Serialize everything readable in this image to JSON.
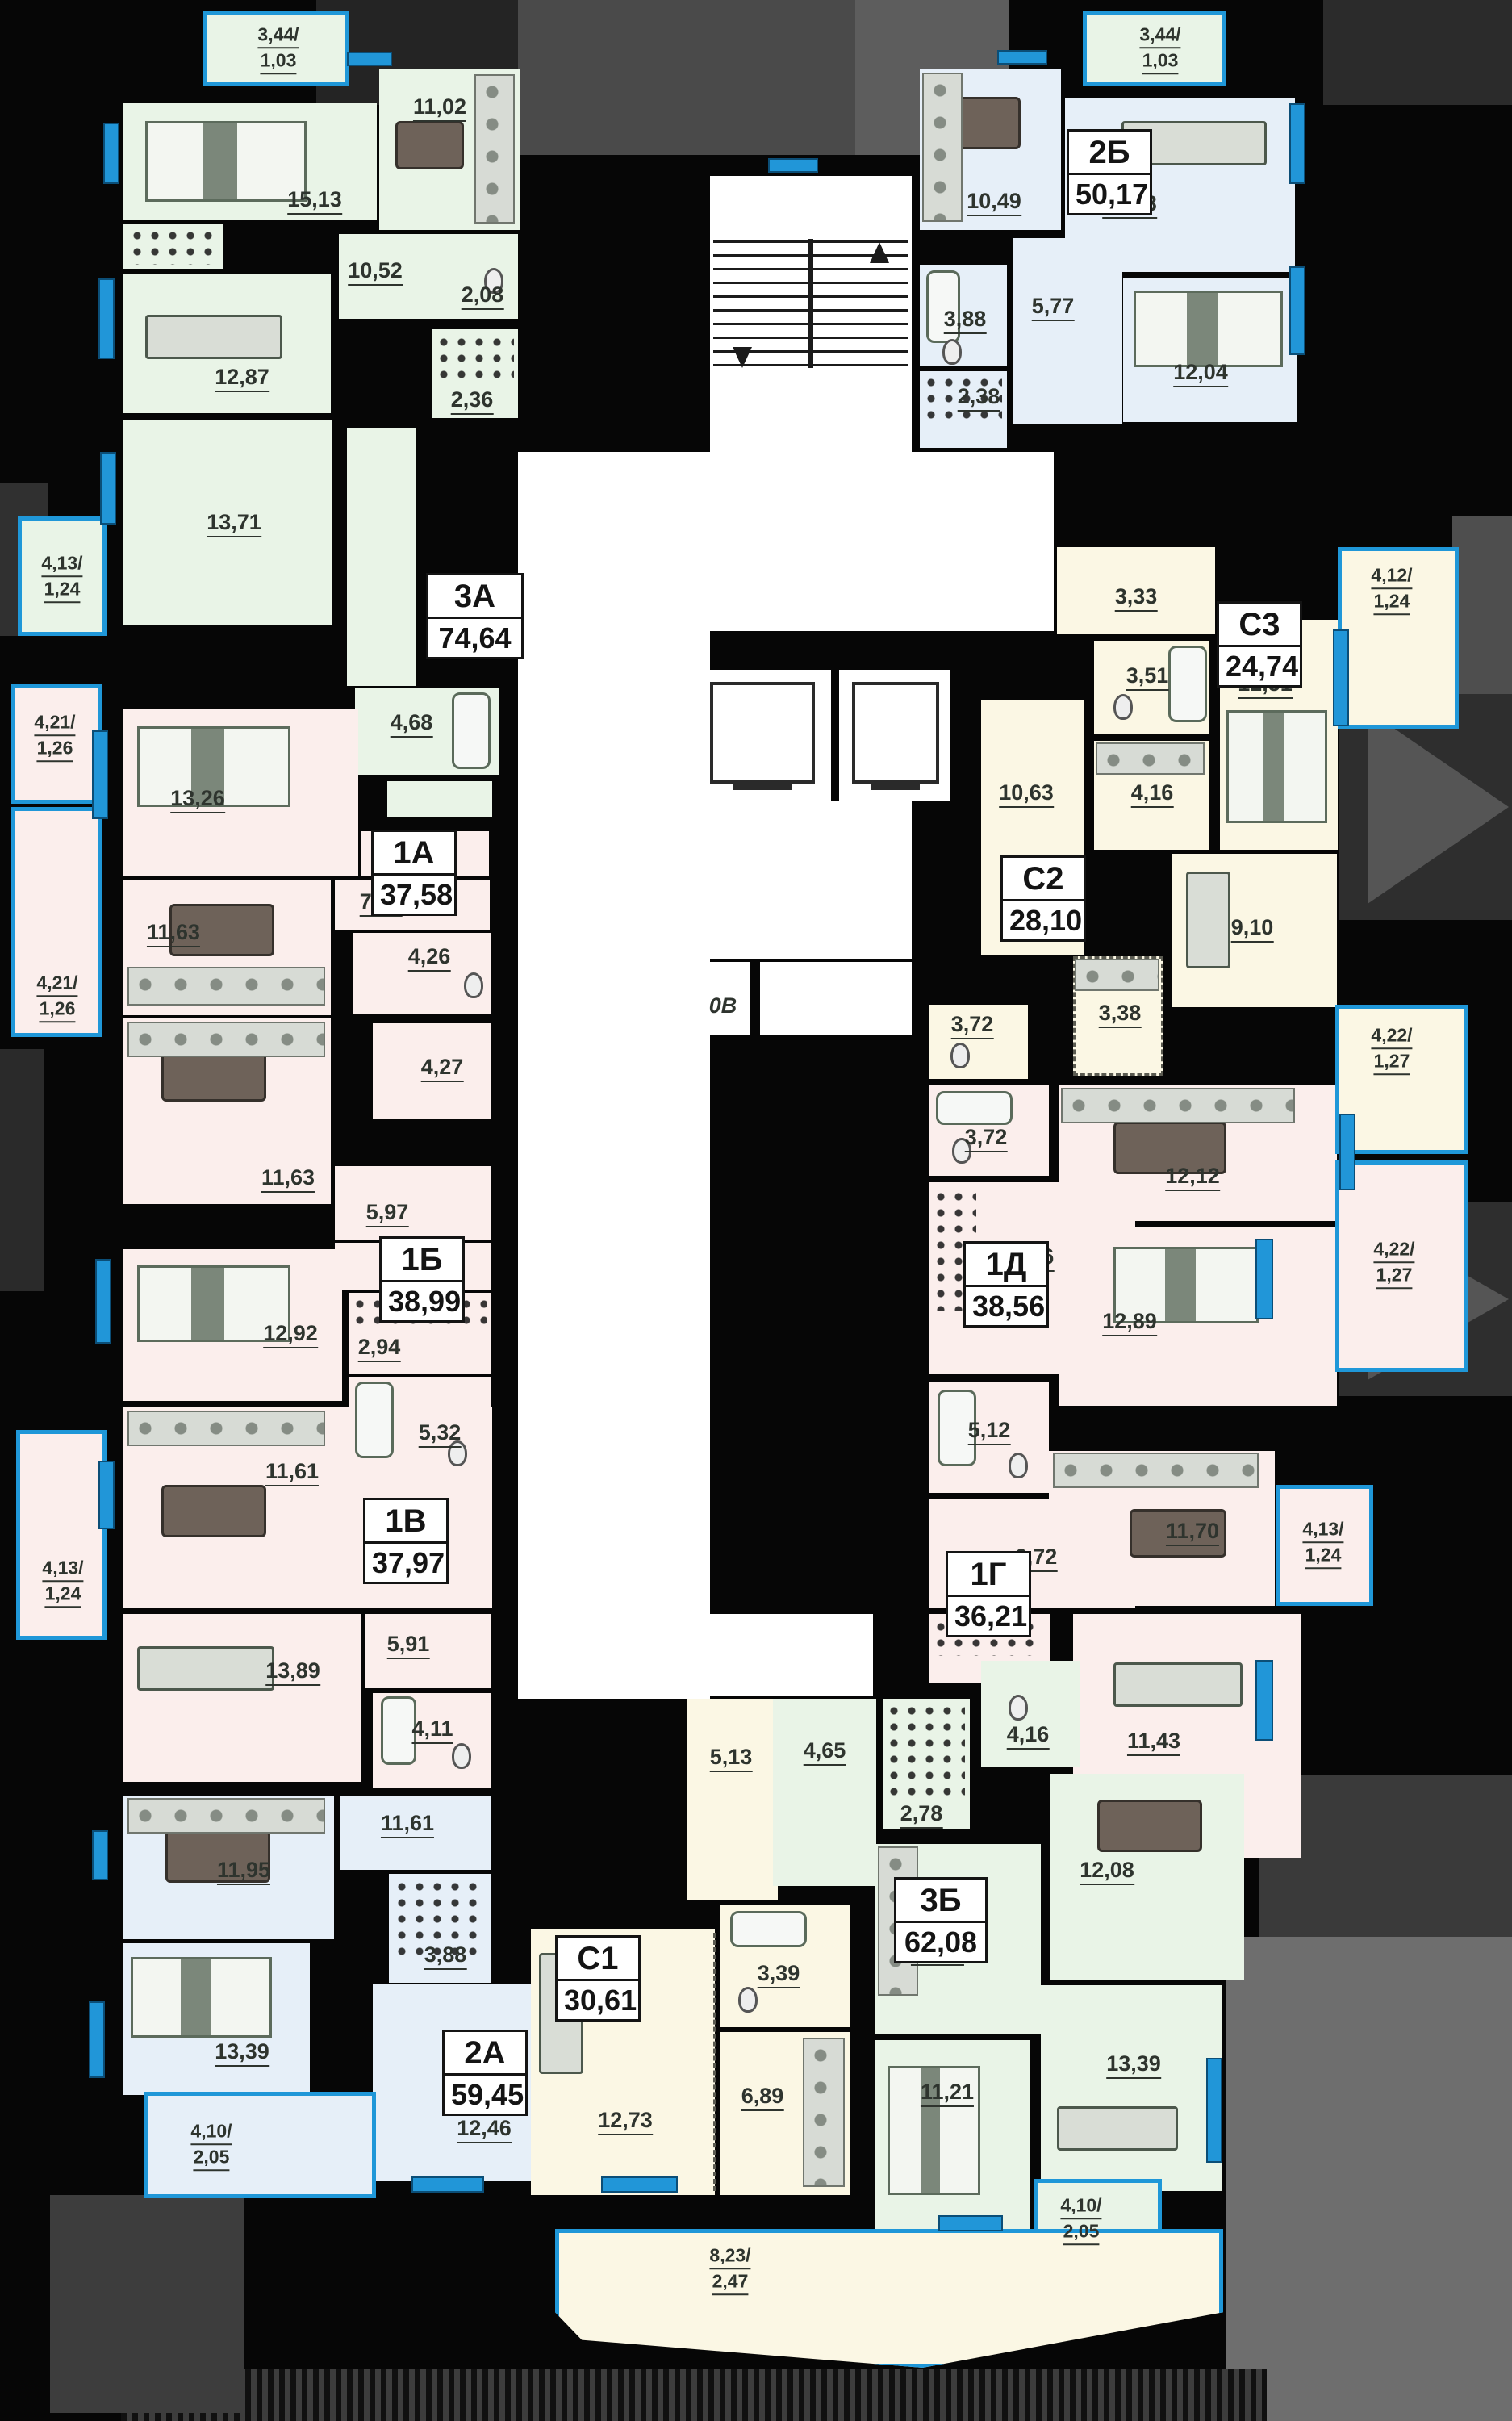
{
  "plan": {
    "title": "Residential floor plan",
    "apartments": [
      {
        "code": "3А",
        "area": "74,64",
        "rooms": [
          "15,13",
          "11,02",
          "10,52",
          "12,87",
          "2,08",
          "2,36",
          "13,71",
          "4,68"
        ]
      },
      {
        "code": "2Б",
        "area": "50,17",
        "rooms": [
          "10,49",
          "15,08",
          "3,88",
          "5,77",
          "2,38",
          "12,04"
        ]
      },
      {
        "code": "С3",
        "area": "24,74",
        "rooms": [
          "3,33",
          "3,51",
          "12,51",
          "4,16"
        ]
      },
      {
        "code": "С2",
        "area": "28,10",
        "rooms": [
          "10,63",
          "3,38",
          "9,10",
          "3,72"
        ]
      },
      {
        "code": "1А",
        "area": "37,58",
        "rooms": [
          "13,26",
          "11,63",
          "7,17",
          "4,26"
        ]
      },
      {
        "code": "1Б",
        "area": "38,99",
        "rooms": [
          "11,63",
          "5,97",
          "12,92",
          "2,94",
          "5,32",
          "4,27"
        ]
      },
      {
        "code": "1В",
        "area": "37,97",
        "rooms": [
          "11,61",
          "13,89",
          "5,91",
          "4,11"
        ]
      },
      {
        "code": "1Д",
        "area": "38,56",
        "rooms": [
          "3,72",
          "12,12",
          "8,56",
          "12,89"
        ]
      },
      {
        "code": "1Г",
        "area": "36,21",
        "rooms": [
          "5,12",
          "6,72",
          "11,70",
          "11,43"
        ]
      },
      {
        "code": "2А",
        "area": "59,45",
        "rooms": [
          "11,95",
          "11,61",
          "3,88",
          "13,39",
          "12,46"
        ]
      },
      {
        "code": "С1",
        "area": "30,61",
        "rooms": [
          "5,13",
          "3,39",
          "6,89",
          "12,73"
        ]
      },
      {
        "code": "3Б",
        "area": "62,08",
        "rooms": [
          "4,65",
          "2,78",
          "4,16",
          "12,08",
          "11,76",
          "11,21",
          "13,39"
        ]
      }
    ],
    "balconies": [
      {
        "a": "3,44/",
        "b": "1,03"
      },
      {
        "a": "3,44/",
        "b": "1,03"
      },
      {
        "a": "4,13/",
        "b": "1,24"
      },
      {
        "a": "4,21/",
        "b": "1,26"
      },
      {
        "a": "4,21/",
        "b": "1,26"
      },
      {
        "a": "4,13/",
        "b": "1,24"
      },
      {
        "a": "4,12/",
        "b": "1,24"
      },
      {
        "a": "4,22/",
        "b": "1,27"
      },
      {
        "a": "4,22/",
        "b": "1,27"
      },
      {
        "a": "4,13/",
        "b": "1,24"
      },
      {
        "a": "4,10/",
        "b": "2,05"
      },
      {
        "a": "4,10/",
        "b": "2,05"
      },
      {
        "a": "8,23/",
        "b": "2,47"
      }
    ],
    "core": {
      "utility": "0В"
    }
  }
}
